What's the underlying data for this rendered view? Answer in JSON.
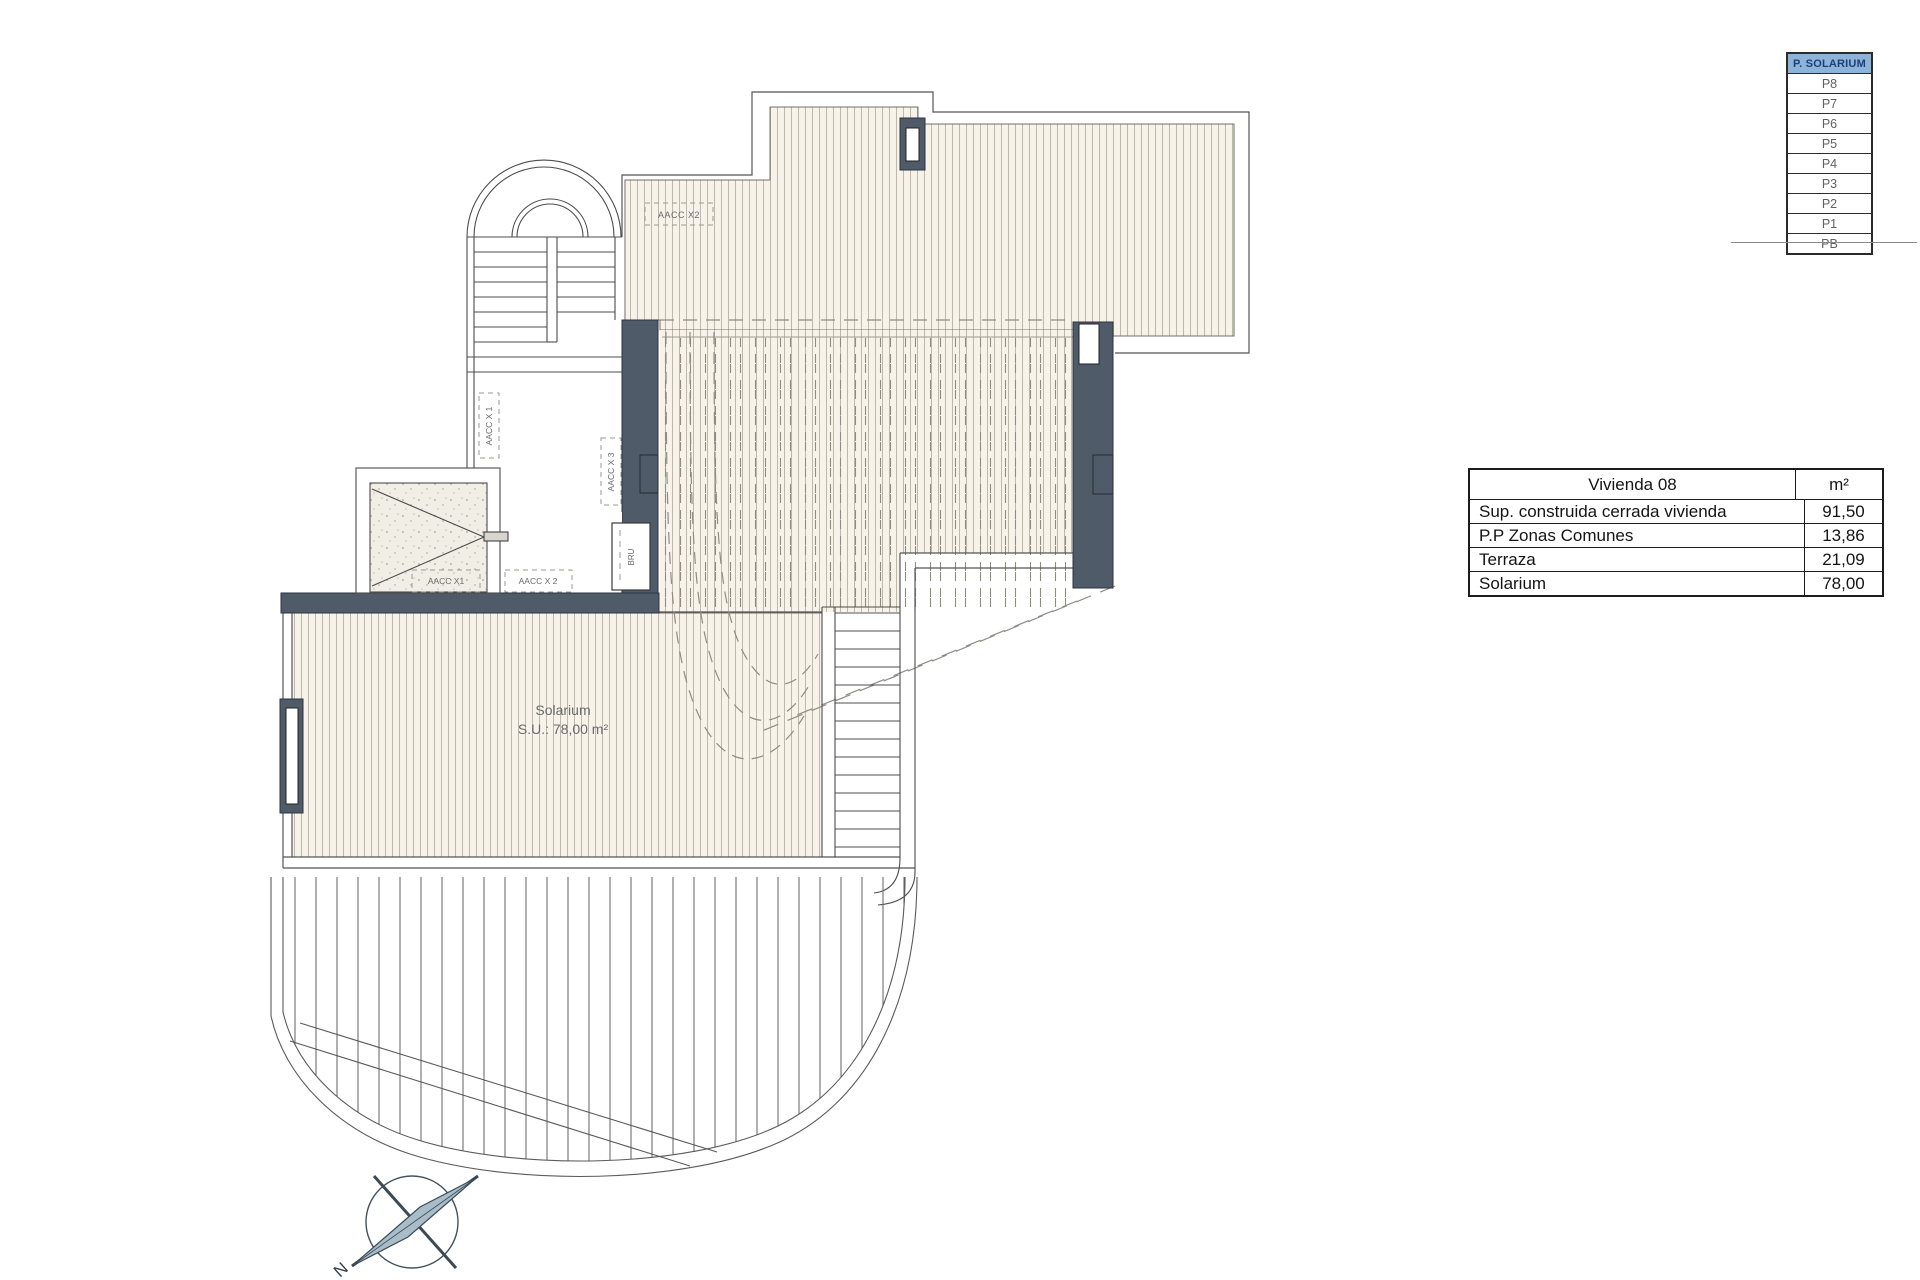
{
  "floors_table": {
    "header": "P. SOLARIUM",
    "rows": [
      "P8",
      "P7",
      "P6",
      "P5",
      "P4",
      "P3",
      "P2",
      "P1",
      "PB"
    ],
    "header_bg": "#8db3d8",
    "header_color": "#1e3f7a"
  },
  "areas_table": {
    "title": "Vivienda 08",
    "unit": "m²",
    "rows": [
      {
        "label": "Sup. construida cerrada vivienda",
        "value": "91,50"
      },
      {
        "label": "P.P Zonas Comunes",
        "value": "13,86"
      },
      {
        "label": "Terraza",
        "value": "21,09"
      },
      {
        "label": "Solarium",
        "value": "78,00"
      }
    ]
  },
  "plan_labels": {
    "solarium_name": "Solarium",
    "solarium_area": "S.U.: 78,00 m²",
    "aacc_top": "AACC X2",
    "aacc_left_vertical": "AACC X 1",
    "aacc_right_vertical": "AACC X 3",
    "aacc_bottom_left": "AACC X1",
    "aacc_bottom": "AACC X 2",
    "bru": "BRU"
  },
  "compass": {
    "north_label": "N"
  },
  "colors": {
    "wall": "#4f5b69",
    "deck_fill": "#f7f3ea",
    "deck_line": "#bcb9a8",
    "hidden_dash": "#8d8d84",
    "outline": "#4c4c4c",
    "compass_needle": "#a9bdc9"
  }
}
